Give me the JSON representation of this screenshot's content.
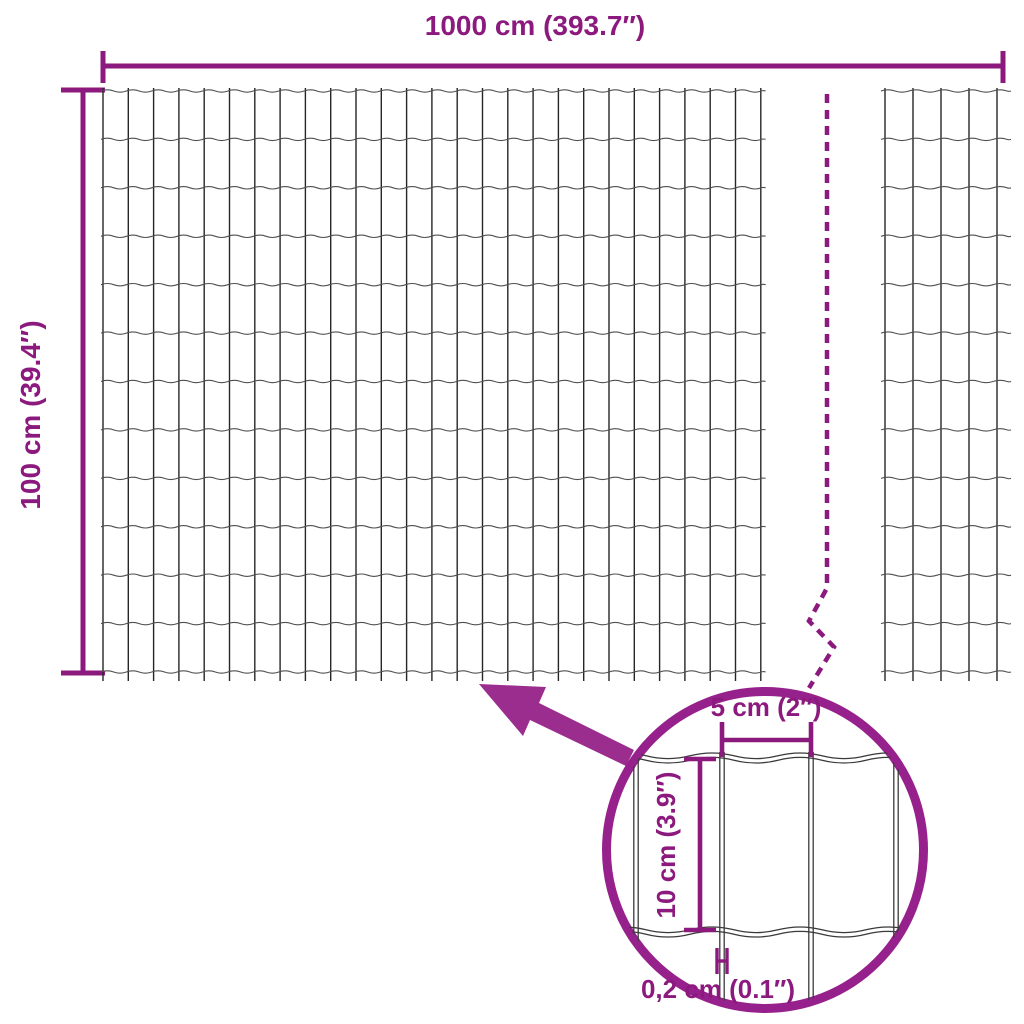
{
  "labels": {
    "total_width": "1000 cm (393.7″)",
    "total_height": "100 cm (39.4″)"
  },
  "detail": {
    "mesh_opening_width": "5 cm (2″)",
    "mesh_opening_height": "10 cm (3.9″)",
    "wire_thickness": "0,2 cm (0.1″)"
  },
  "colors": {
    "background": "#ffffff",
    "accent": "#8c1a7e",
    "arrow": "#9b2d8e",
    "circle": "#97218c",
    "wire_vertical": "#262626",
    "wire_horizontal": "#4f4f4f",
    "wire_detail": "#3a3a3a"
  }
}
